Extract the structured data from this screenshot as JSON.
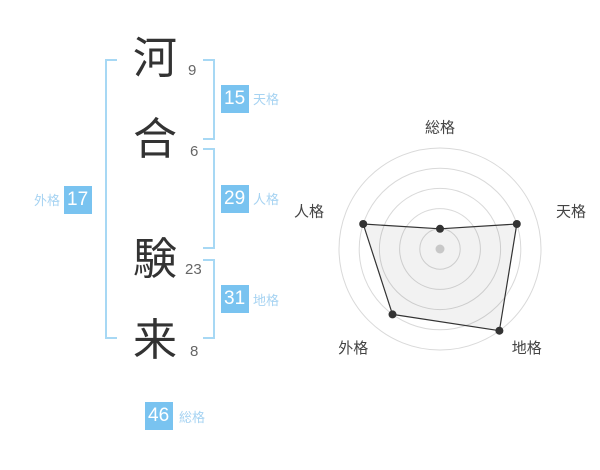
{
  "colors": {
    "badge_bg": "#79c3f0",
    "light_blue_text": "#a6d3f2",
    "bracket": "#a7d8f4",
    "kanji_text": "#333333",
    "stroke_count_text": "#666666",
    "ring": "#d9d9d9",
    "polygon_stroke": "#333333",
    "polygon_fill": "rgba(0,0,0,0.05)",
    "vertex_dot": "#333333",
    "center_dot": "#c8c8c8",
    "axis_label": "#444444"
  },
  "name_panel": {
    "characters": [
      {
        "char": "河",
        "strokes": "9"
      },
      {
        "char": "合",
        "strokes": "6"
      },
      {
        "char": "験",
        "strokes": "23"
      },
      {
        "char": "来",
        "strokes": "8"
      }
    ],
    "badges": [
      {
        "id": "tenkaku",
        "value": "15",
        "label": "天格"
      },
      {
        "id": "jinkaku",
        "value": "29",
        "label": "人格"
      },
      {
        "id": "chikaku",
        "value": "31",
        "label": "地格"
      },
      {
        "id": "gaikaku",
        "value": "17",
        "label": "外格"
      },
      {
        "id": "soukaku",
        "value": "46",
        "label": "総格"
      }
    ]
  },
  "chart_data": {
    "type": "radar",
    "axes": [
      "総格",
      "天格",
      "地格",
      "外格",
      "人格"
    ],
    "values": [
      1,
      4,
      5,
      4,
      4
    ],
    "max": 5,
    "rings": 5,
    "start_angle_deg": 90,
    "direction": "clockwise",
    "legend": "none",
    "scores_by_axis": {
      "総格": 46,
      "天格": 15,
      "地格": 31,
      "外格": 17,
      "人格": 29
    }
  }
}
